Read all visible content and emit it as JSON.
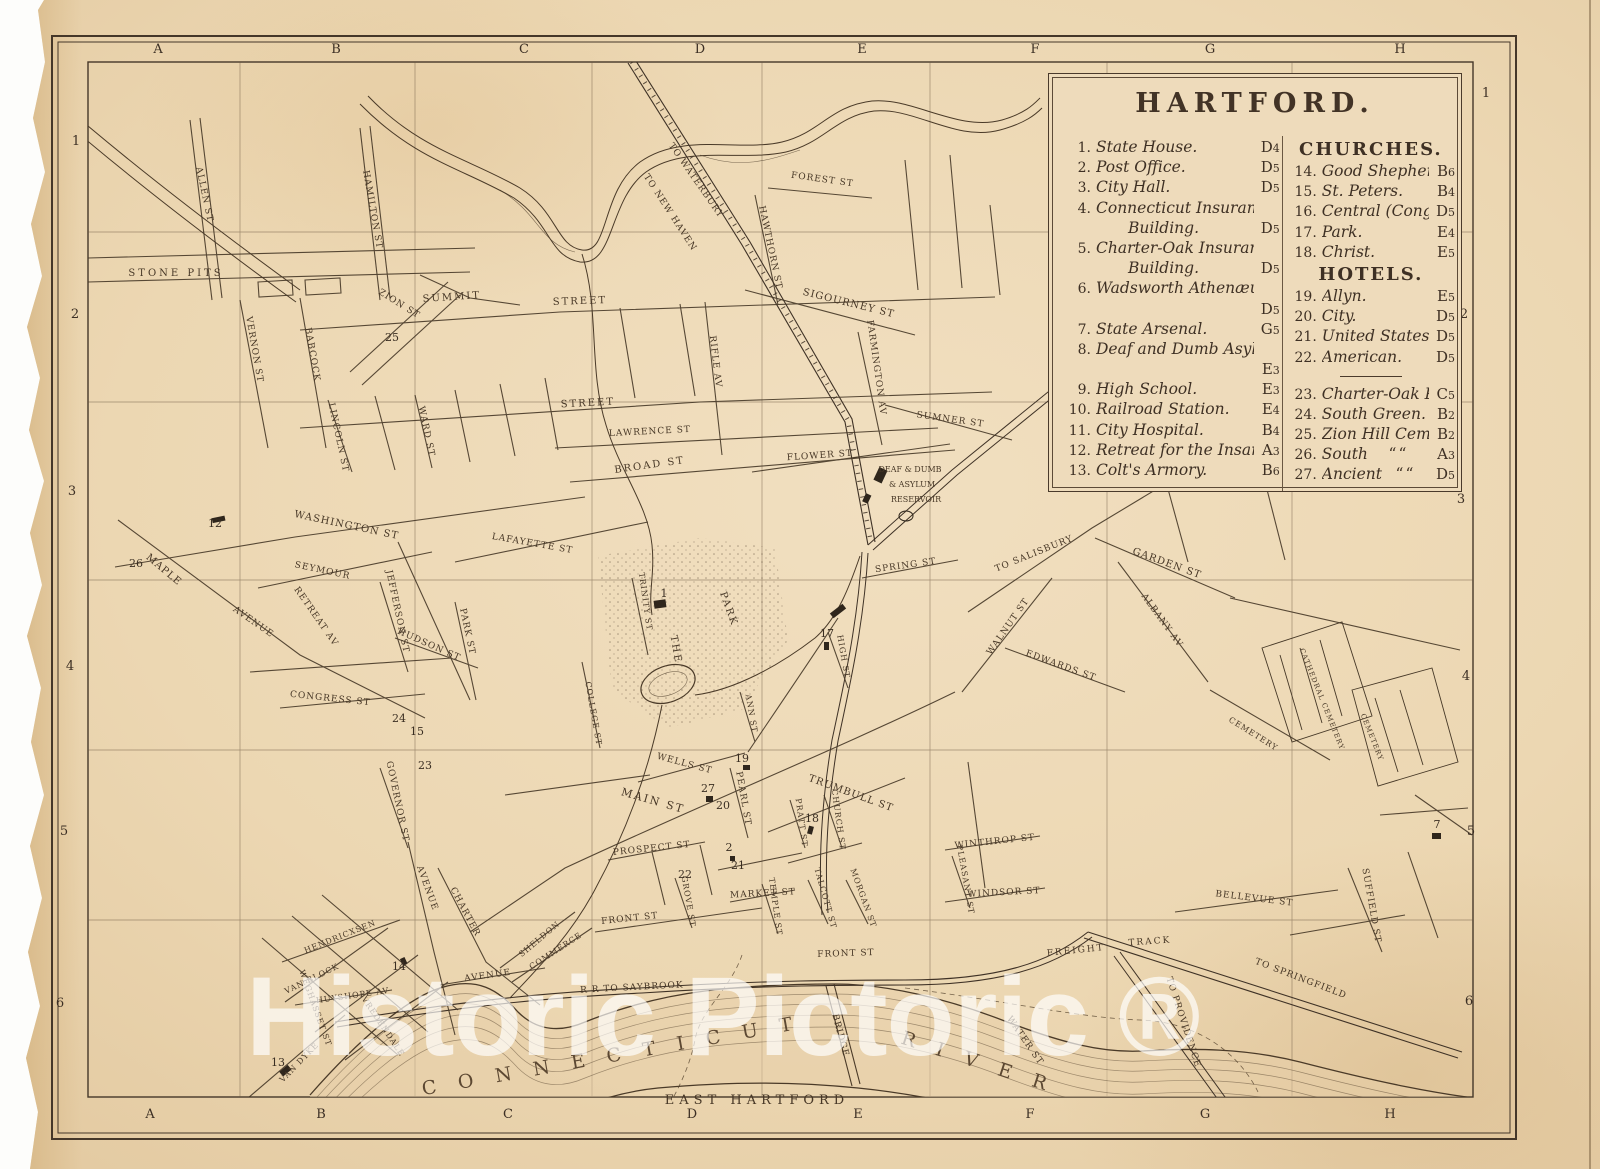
{
  "legend": {
    "title": "HARTFORD.",
    "items": [
      {
        "num": "1.",
        "label": "State House.",
        "ref": "D4"
      },
      {
        "num": "2.",
        "label": "Post Office.",
        "ref": "D5"
      },
      {
        "num": "3.",
        "label": "City Hall.",
        "ref": "D5"
      },
      {
        "num": "4.",
        "label": "Connecticut Insurance",
        "label2": "Building.",
        "ref": "D5"
      },
      {
        "num": "5.",
        "label": "Charter-Oak Insurance",
        "label2": "Building.",
        "ref": "D5"
      },
      {
        "num": "6.",
        "label": "Wadsworth Athenæum.",
        "ref": "D5",
        "ref_newline": true
      },
      {
        "num": "7.",
        "label": "State Arsenal.",
        "ref": "G5"
      },
      {
        "num": "8.",
        "label": "Deaf and Dumb Asylum.",
        "ref": "E3",
        "ref_newline": true
      },
      {
        "num": "9.",
        "label": "High School.",
        "ref": "E3"
      },
      {
        "num": "10.",
        "label": "Railroad Station.",
        "ref": "E4"
      },
      {
        "num": "11.",
        "label": "City Hospital.",
        "ref": "B4"
      },
      {
        "num": "12.",
        "label": "Retreat for the Insane.",
        "ref": "A3"
      },
      {
        "num": "13.",
        "label": "Colt's Armory.",
        "ref": "B6"
      }
    ],
    "churches_heading": "CHURCHES.",
    "churches": [
      {
        "num": "14.",
        "label": "Good Shepherd.",
        "ref": "B6"
      },
      {
        "num": "15.",
        "label": "St. Peters.",
        "ref": "B4"
      },
      {
        "num": "16.",
        "label": "Central (Cong.).",
        "ref": "D5"
      },
      {
        "num": "17.",
        "label": "Park.",
        "ref": "E4"
      },
      {
        "num": "18.",
        "label": "Christ.",
        "ref": "E5"
      }
    ],
    "hotels_heading": "HOTELS.",
    "hotels": [
      {
        "num": "19.",
        "label": "Allyn.",
        "ref": "E5"
      },
      {
        "num": "20.",
        "label": "City.",
        "ref": "D5"
      },
      {
        "num": "21.",
        "label": "United States.",
        "ref": "D5"
      },
      {
        "num": "22.",
        "label": "American.",
        "ref": "D5"
      }
    ],
    "places": [
      {
        "num": "23.",
        "label": "Charter-Oak Place.",
        "ref": "C5"
      },
      {
        "num": "24.",
        "label": "South Green.",
        "ref": "B2"
      },
      {
        "num": "25.",
        "label": "Zion Hill Cemetery.",
        "ref": "B2"
      },
      {
        "num": "26.",
        "label": "South",
        "ditto": "“",
        "ref": "A3"
      },
      {
        "num": "27.",
        "label": "Ancient",
        "ditto": "“",
        "ref": "D5"
      }
    ]
  },
  "grid": {
    "letters": [
      "A",
      "B",
      "C",
      "D",
      "E",
      "F",
      "G",
      "H"
    ],
    "top_x": [
      158,
      336,
      524,
      700,
      862,
      1035,
      1210,
      1400
    ],
    "top_y": 53,
    "bottom_x": [
      150,
      321,
      508,
      692,
      858,
      1030,
      1205,
      1390
    ],
    "bottom_y": 1118,
    "numbers": [
      "1",
      "2",
      "3",
      "4",
      "5",
      "6"
    ],
    "left_x": [
      76,
      75,
      72,
      70,
      64,
      60
    ],
    "left_y": [
      145,
      318,
      495,
      670,
      835,
      1007
    ],
    "right_x": [
      1486,
      1464,
      1461,
      1466,
      1471,
      1469
    ],
    "right_y": [
      97,
      318,
      503,
      680,
      835,
      1005
    ]
  },
  "map": {
    "labels": [
      {
        "t": "STONE PITS",
        "x": 176,
        "y": 276,
        "r": 0,
        "s": 10,
        "ls": 3
      },
      {
        "t": "ALLEN ST",
        "x": 202,
        "y": 195,
        "r": 78,
        "s": 9,
        "ls": 1
      },
      {
        "t": "HAMILTON ST",
        "x": 370,
        "y": 210,
        "r": 80,
        "s": 9,
        "ls": 1
      },
      {
        "t": "VERNON ST",
        "x": 252,
        "y": 350,
        "r": 80,
        "s": 9,
        "ls": 1
      },
      {
        "t": "BABCOCK",
        "x": 310,
        "y": 355,
        "r": 80,
        "s": 9,
        "ls": 1
      },
      {
        "t": "LINCOLN ST",
        "x": 336,
        "y": 438,
        "r": 78,
        "s": 9,
        "ls": 1
      },
      {
        "t": "WARD ST",
        "x": 424,
        "y": 432,
        "r": 78,
        "s": 9,
        "ls": 1
      },
      {
        "t": "ZION ST",
        "x": 398,
        "y": 306,
        "r": 32,
        "s": 9,
        "ls": 1
      },
      {
        "t": "SUMMIT",
        "x": 452,
        "y": 300,
        "r": -4,
        "s": 10,
        "ls": 2
      },
      {
        "t": "STREET",
        "x": 580,
        "y": 304,
        "r": -2,
        "s": 10,
        "ls": 2
      },
      {
        "t": "STREET",
        "x": 588,
        "y": 406,
        "r": -3,
        "s": 10,
        "ls": 2
      },
      {
        "t": "LAWRENCE ST",
        "x": 650,
        "y": 434,
        "r": -3,
        "s": 9,
        "ls": 1
      },
      {
        "t": "BROAD ST",
        "x": 650,
        "y": 468,
        "r": -8,
        "s": 10,
        "ls": 2
      },
      {
        "t": "RIFLE AV",
        "x": 713,
        "y": 362,
        "r": 83,
        "s": 9,
        "ls": 1
      },
      {
        "t": "FLOWER ST",
        "x": 820,
        "y": 458,
        "r": -4,
        "s": 9,
        "ls": 1
      },
      {
        "t": "SIGOURNEY ST",
        "x": 848,
        "y": 306,
        "r": 14,
        "s": 10,
        "ls": 1
      },
      {
        "t": "FARMINGTON AV",
        "x": 874,
        "y": 368,
        "r": 82,
        "s": 9,
        "ls": 1
      },
      {
        "t": "FOREST ST",
        "x": 822,
        "y": 182,
        "r": 8,
        "s": 9,
        "ls": 1
      },
      {
        "t": "HAWTHORN ST",
        "x": 768,
        "y": 248,
        "r": 78,
        "s": 9,
        "ls": 1
      },
      {
        "t": "TO WATERBURY",
        "x": 694,
        "y": 182,
        "r": 55,
        "s": 9,
        "ls": 1
      },
      {
        "t": "TO NEW HAVEN",
        "x": 668,
        "y": 214,
        "r": 57,
        "s": 9,
        "ls": 1
      },
      {
        "t": "SUMNER ST",
        "x": 950,
        "y": 422,
        "r": 8,
        "s": 9,
        "ls": 1
      },
      {
        "t": "DEAF & DUMB",
        "x": 910,
        "y": 472,
        "r": 0,
        "s": 8,
        "ls": 0
      },
      {
        "t": "& ASYLUM",
        "x": 912,
        "y": 487,
        "r": 0,
        "s": 8,
        "ls": 0
      },
      {
        "t": "RESERVOIR",
        "x": 916,
        "y": 502,
        "r": 0,
        "s": 8,
        "ls": 0
      },
      {
        "t": "TO SALISBURY",
        "x": 1035,
        "y": 556,
        "r": -22,
        "s": 9,
        "ls": 1
      },
      {
        "t": "GARDEN ST",
        "x": 1166,
        "y": 566,
        "r": 20,
        "s": 10,
        "ls": 1
      },
      {
        "t": "ALBANY AV",
        "x": 1160,
        "y": 622,
        "r": 54,
        "s": 9,
        "ls": 1
      },
      {
        "t": "WALNUT ST",
        "x": 1010,
        "y": 628,
        "r": -55,
        "s": 9,
        "ls": 1
      },
      {
        "t": "EDWARDS ST",
        "x": 1060,
        "y": 668,
        "r": 20,
        "s": 9,
        "ls": 1
      },
      {
        "t": "SPRING ST",
        "x": 906,
        "y": 568,
        "r": -8,
        "s": 9,
        "ls": 1
      },
      {
        "t": "CEMETERY",
        "x": 1252,
        "y": 736,
        "r": 32,
        "s": 8,
        "ls": 1
      },
      {
        "t": "CATHEDRAL CEMETERY",
        "x": 1320,
        "y": 700,
        "r": 68,
        "s": 7,
        "ls": 1
      },
      {
        "t": "CEMETERY",
        "x": 1370,
        "y": 738,
        "r": 68,
        "s": 7,
        "ls": 1
      },
      {
        "t": "WASHINGTON ST",
        "x": 346,
        "y": 528,
        "r": 12,
        "s": 10,
        "ls": 1
      },
      {
        "t": "LAFAYETTE ST",
        "x": 532,
        "y": 546,
        "r": 10,
        "s": 9,
        "ls": 1
      },
      {
        "t": "SEYMOUR",
        "x": 322,
        "y": 573,
        "r": 12,
        "s": 9,
        "ls": 1
      },
      {
        "t": "MAPLE",
        "x": 162,
        "y": 572,
        "r": 40,
        "s": 10,
        "ls": 1
      },
      {
        "t": "AVENUE",
        "x": 252,
        "y": 624,
        "r": 35,
        "s": 9,
        "ls": 1
      },
      {
        "t": "RETREAT AV",
        "x": 314,
        "y": 618,
        "r": 55,
        "s": 9,
        "ls": 1
      },
      {
        "t": "JEFFERSON ST",
        "x": 395,
        "y": 612,
        "r": 78,
        "s": 9,
        "ls": 1
      },
      {
        "t": "HUDSON ST",
        "x": 428,
        "y": 647,
        "r": 24,
        "s": 9,
        "ls": 1
      },
      {
        "t": "PARK ST",
        "x": 465,
        "y": 632,
        "r": 78,
        "s": 9,
        "ls": 1
      },
      {
        "t": "CONGRESS ST",
        "x": 330,
        "y": 701,
        "r": 6,
        "s": 9,
        "ls": 1
      },
      {
        "t": "GOVERNOR ST",
        "x": 395,
        "y": 802,
        "r": 78,
        "s": 9,
        "ls": 1
      },
      {
        "t": "THE",
        "x": 673,
        "y": 650,
        "r": 80,
        "s": 10,
        "ls": 2
      },
      {
        "t": "PARK",
        "x": 726,
        "y": 610,
        "r": 70,
        "s": 10,
        "ls": 2
      },
      {
        "t": "TRINITY ST",
        "x": 643,
        "y": 602,
        "r": 82,
        "s": 8,
        "ls": 1
      },
      {
        "t": "COLLEGE ST",
        "x": 591,
        "y": 714,
        "r": 80,
        "s": 8,
        "ls": 1
      },
      {
        "t": "MAIN ST",
        "x": 652,
        "y": 804,
        "r": 16,
        "s": 11,
        "ls": 2
      },
      {
        "t": "WELLS ST",
        "x": 684,
        "y": 766,
        "r": 15,
        "s": 9,
        "ls": 1
      },
      {
        "t": "PEARL ST",
        "x": 741,
        "y": 799,
        "r": 80,
        "s": 9,
        "ls": 1
      },
      {
        "t": "TRUMBULL ST",
        "x": 850,
        "y": 796,
        "r": 20,
        "s": 10,
        "ls": 1
      },
      {
        "t": "PRATT ST",
        "x": 799,
        "y": 823,
        "r": 82,
        "s": 8,
        "ls": 1
      },
      {
        "t": "CHURCH ST",
        "x": 836,
        "y": 820,
        "r": 82,
        "s": 8,
        "ls": 1
      },
      {
        "t": "ANN ST",
        "x": 749,
        "y": 714,
        "r": 80,
        "s": 8,
        "ls": 1
      },
      {
        "t": "HIGH ST",
        "x": 841,
        "y": 657,
        "r": 80,
        "s": 8,
        "ls": 1
      },
      {
        "t": "PROSPECT ST",
        "x": 652,
        "y": 851,
        "r": -6,
        "s": 9,
        "ls": 1
      },
      {
        "t": "GROVE ST",
        "x": 686,
        "y": 902,
        "r": 80,
        "s": 8,
        "ls": 1
      },
      {
        "t": "MARKET ST",
        "x": 763,
        "y": 896,
        "r": -3,
        "s": 9,
        "ls": 1
      },
      {
        "t": "TEMPLE ST",
        "x": 773,
        "y": 907,
        "r": 82,
        "s": 8,
        "ls": 1
      },
      {
        "t": "TALCOTT ST",
        "x": 823,
        "y": 899,
        "r": 74,
        "s": 8,
        "ls": 1
      },
      {
        "t": "MORGAN ST",
        "x": 861,
        "y": 899,
        "r": 70,
        "s": 8,
        "ls": 1
      },
      {
        "t": "FRONT ST",
        "x": 630,
        "y": 921,
        "r": -6,
        "s": 9,
        "ls": 1
      },
      {
        "t": "FRONT ST",
        "x": 846,
        "y": 956,
        "r": -2,
        "s": 9,
        "ls": 1
      },
      {
        "t": "WINDSOR ST",
        "x": 1004,
        "y": 895,
        "r": -3,
        "s": 9,
        "ls": 1
      },
      {
        "t": "WINTHROP ST",
        "x": 995,
        "y": 844,
        "r": -6,
        "s": 9,
        "ls": 1
      },
      {
        "t": "PLEASANT ST",
        "x": 963,
        "y": 880,
        "r": 80,
        "s": 8,
        "ls": 1
      },
      {
        "t": "BELLEVUE ST",
        "x": 1254,
        "y": 901,
        "r": 7,
        "s": 9,
        "ls": 1
      },
      {
        "t": "SUFFIELD ST",
        "x": 1369,
        "y": 906,
        "r": 80,
        "s": 9,
        "ls": 1
      },
      {
        "t": "FREIGHT",
        "x": 1076,
        "y": 953,
        "r": -6,
        "s": 9,
        "ls": 2
      },
      {
        "t": "TRACK",
        "x": 1150,
        "y": 944,
        "r": -4,
        "s": 9,
        "ls": 2
      },
      {
        "t": "TO SPRINGFIELD",
        "x": 1300,
        "y": 981,
        "r": 21,
        "s": 9,
        "ls": 1
      },
      {
        "t": "TO PROVIDENCE",
        "x": 1181,
        "y": 1023,
        "r": 72,
        "s": 9,
        "ls": 1
      },
      {
        "t": "WATER ST",
        "x": 1023,
        "y": 1042,
        "r": 55,
        "s": 9,
        "ls": 1
      },
      {
        "t": "R R TO SAYBROOK",
        "x": 632,
        "y": 990,
        "r": -3,
        "s": 9,
        "ls": 1
      },
      {
        "t": "C O N N E C T I C U T",
        "x": 612,
        "y": 1062,
        "r": -10,
        "s": 19,
        "ls": 8
      },
      {
        "t": "R I V E R",
        "x": 976,
        "y": 1068,
        "r": 18,
        "s": 19,
        "ls": 8
      },
      {
        "t": "EAST HARTFORD",
        "x": 757,
        "y": 1104,
        "r": 0,
        "s": 13,
        "ls": 5
      },
      {
        "t": "BRIDGE",
        "x": 838,
        "y": 1036,
        "r": 75,
        "s": 9,
        "ls": 1
      },
      {
        "t": "HENDRICXSEN",
        "x": 341,
        "y": 939,
        "r": -22,
        "s": 8,
        "ls": 1
      },
      {
        "t": "VAN BLOCK",
        "x": 313,
        "y": 981,
        "r": -26,
        "s": 8,
        "ls": 1
      },
      {
        "t": "WEGHASSET ST",
        "x": 313,
        "y": 1009,
        "r": 70,
        "s": 8,
        "ls": 1
      },
      {
        "t": "HUYSHOPE AV",
        "x": 353,
        "y": 998,
        "r": -8,
        "s": 8,
        "ls": 1
      },
      {
        "t": "VREDENDALE",
        "x": 381,
        "y": 1028,
        "r": 56,
        "s": 8,
        "ls": 1
      },
      {
        "t": "VAN DYKE",
        "x": 301,
        "y": 1064,
        "r": -46,
        "s": 8,
        "ls": 1
      },
      {
        "t": "CHARTER",
        "x": 463,
        "y": 913,
        "r": 62,
        "s": 9,
        "ls": 1
      },
      {
        "t": "AVENUE",
        "x": 488,
        "y": 978,
        "r": -8,
        "s": 9,
        "ls": 1
      },
      {
        "t": "AVENUE",
        "x": 425,
        "y": 889,
        "r": 70,
        "s": 9,
        "ls": 1
      },
      {
        "t": "SHELDON",
        "x": 541,
        "y": 941,
        "r": -40,
        "s": 8,
        "ls": 1
      },
      {
        "t": "COMMERCE",
        "x": 557,
        "y": 953,
        "r": -33,
        "s": 8,
        "ls": 1
      }
    ],
    "markers": [
      {
        "n": "25",
        "x": 392,
        "y": 341
      },
      {
        "n": "12",
        "x": 215,
        "y": 527
      },
      {
        "n": "26",
        "x": 136,
        "y": 567
      },
      {
        "n": "24",
        "x": 399,
        "y": 722
      },
      {
        "n": "15",
        "x": 417,
        "y": 735
      },
      {
        "n": "23",
        "x": 425,
        "y": 769
      },
      {
        "n": "14",
        "x": 399,
        "y": 970
      },
      {
        "n": "13",
        "x": 278,
        "y": 1066
      },
      {
        "n": "27",
        "x": 708,
        "y": 792
      },
      {
        "n": "20",
        "x": 723,
        "y": 809
      },
      {
        "n": "19",
        "x": 742,
        "y": 762
      },
      {
        "n": "2",
        "x": 729,
        "y": 851
      },
      {
        "n": "21",
        "x": 738,
        "y": 869
      },
      {
        "n": "22",
        "x": 685,
        "y": 878
      },
      {
        "n": "18",
        "x": 812,
        "y": 822
      },
      {
        "n": "17",
        "x": 827,
        "y": 637
      },
      {
        "n": "1",
        "x": 664,
        "y": 597
      },
      {
        "n": "7",
        "x": 1437,
        "y": 828
      }
    ]
  },
  "watermark": "Historic Pictoric ®"
}
